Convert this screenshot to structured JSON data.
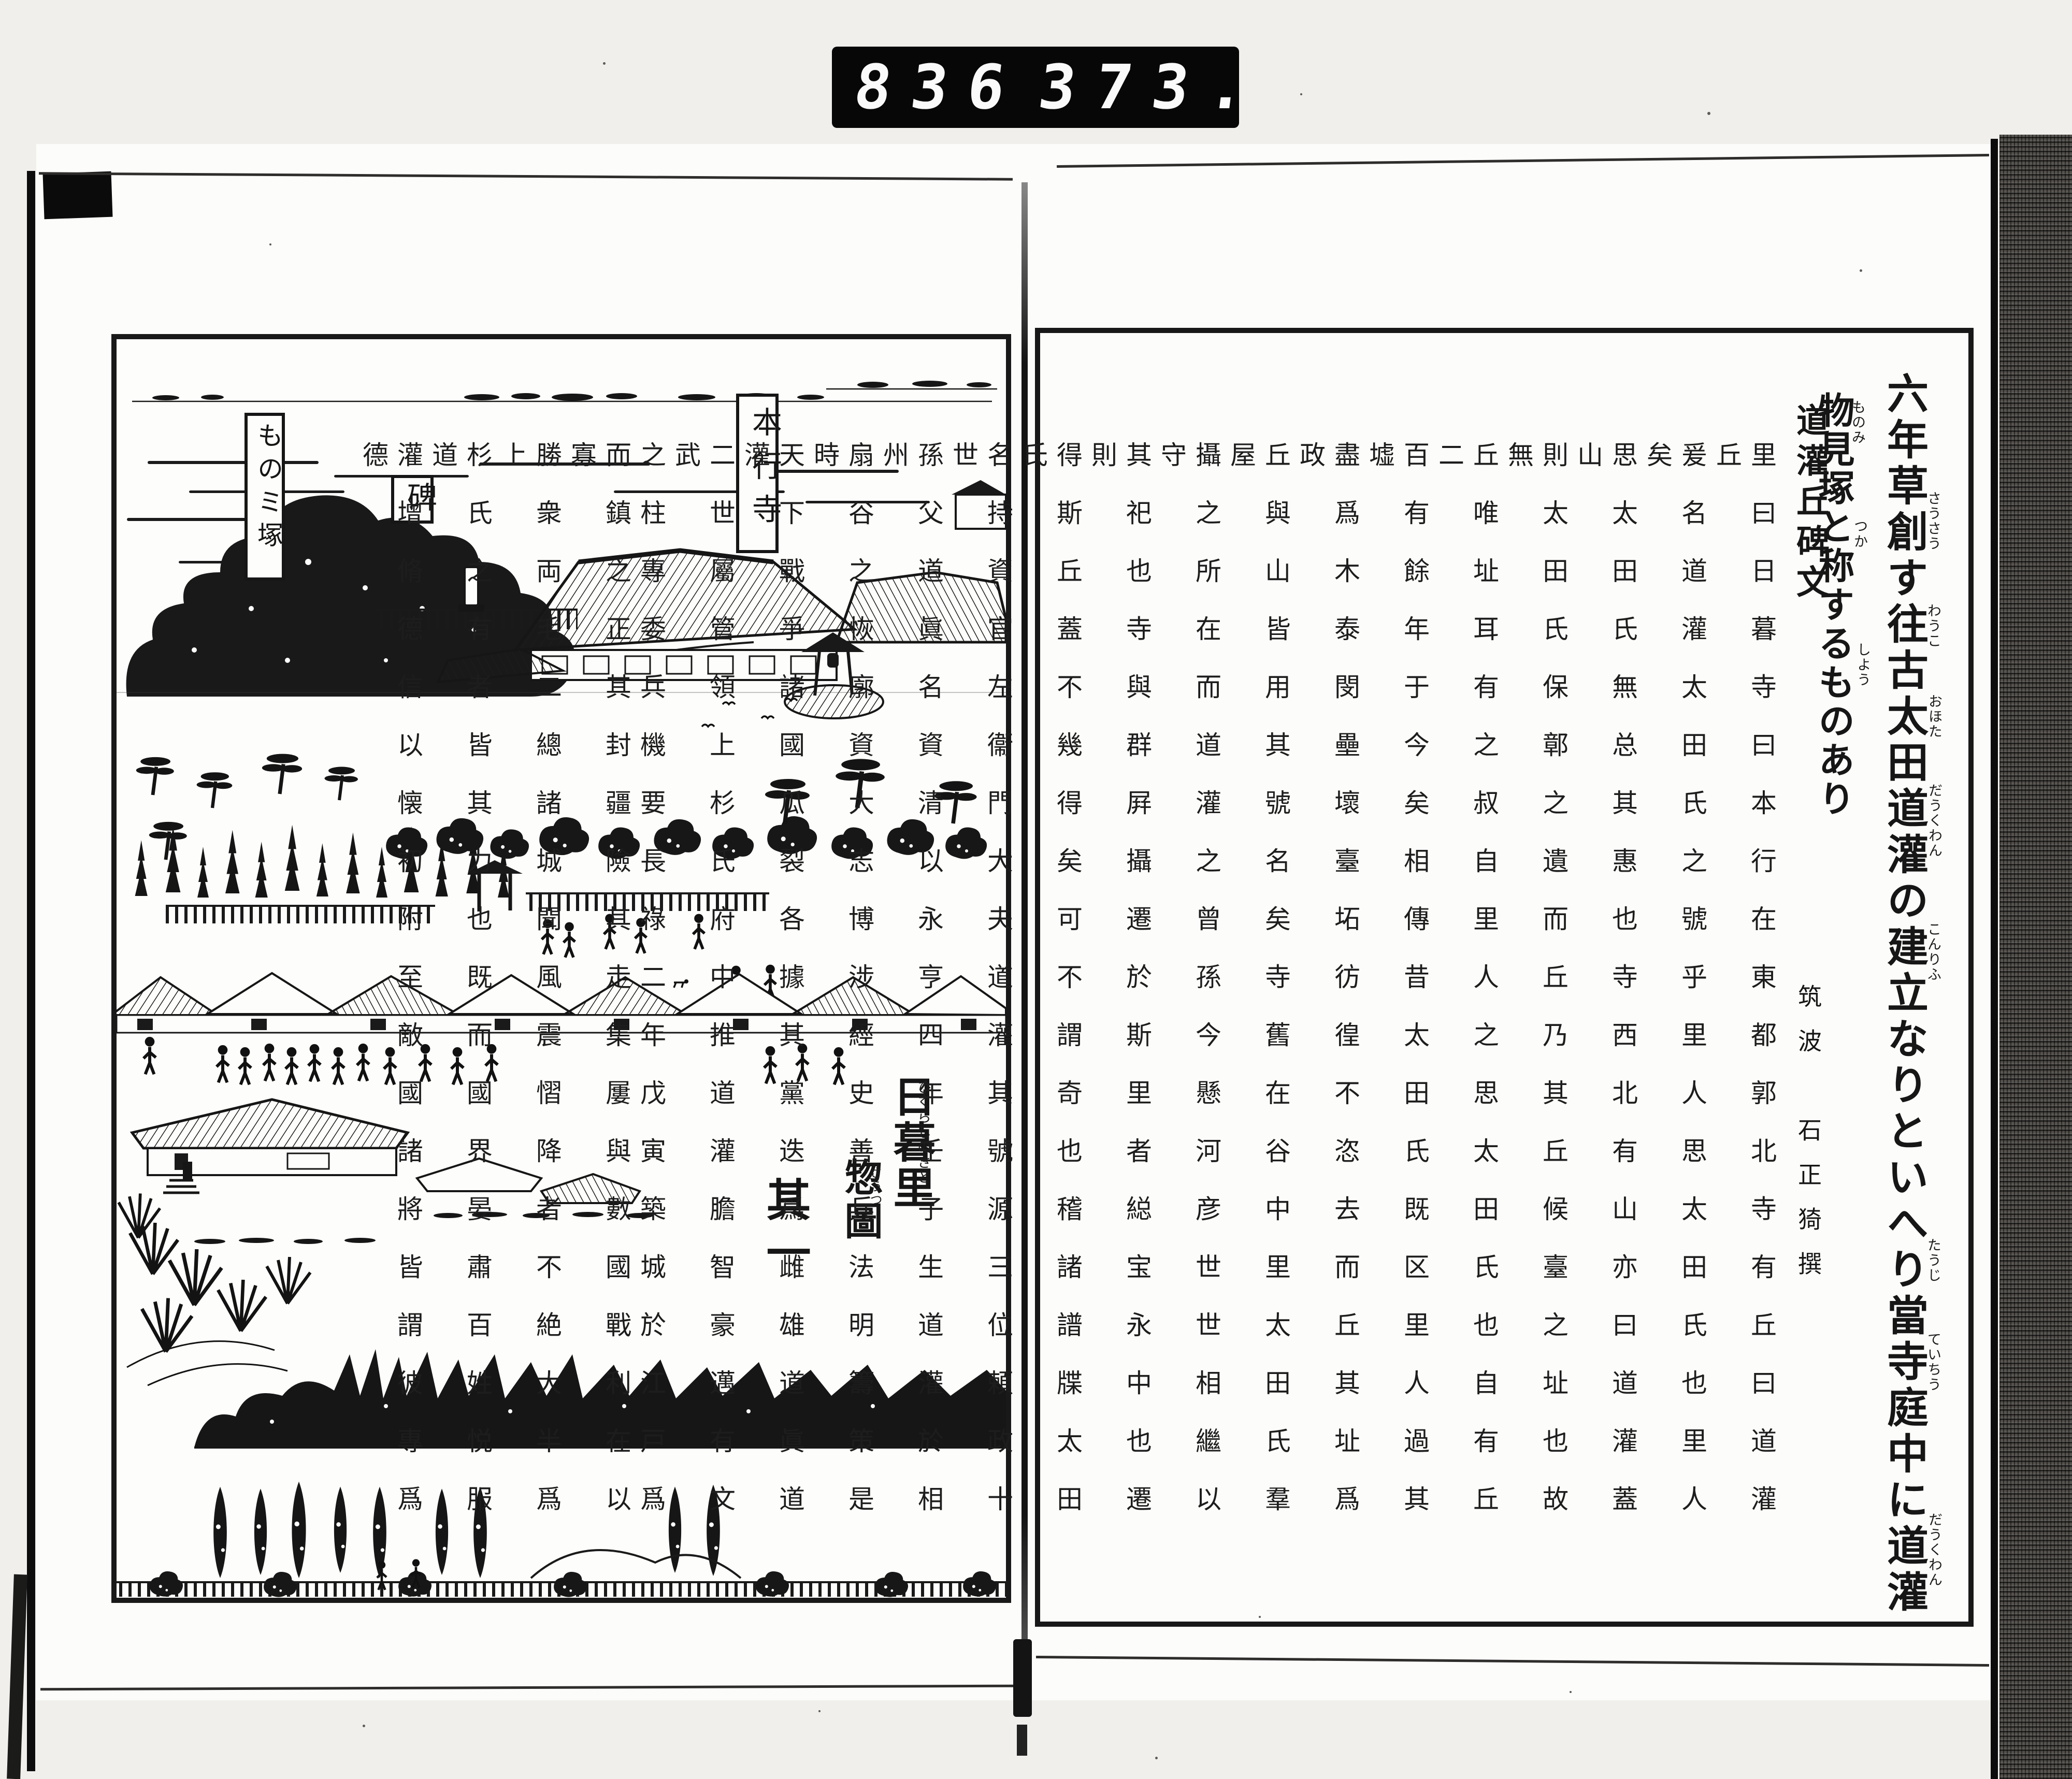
{
  "scan": {
    "frame_counter": {
      "left": "836",
      "right": "373."
    },
    "colors": {
      "ink": "#1a1a1a",
      "paper": "#fcfcfa",
      "background": "#f0efec",
      "counter_bg": "#070707",
      "counter_digit": "#fafafa",
      "film_strip": "#53504c"
    }
  },
  "left_page": {
    "cartouches": [
      {
        "label": "ものミ塚"
      },
      {
        "label": "碑"
      },
      {
        "label": "本行寺"
      }
    ],
    "illustration_title": {
      "main": "日暮里",
      "main_furigana": "ひくらしのさと",
      "sub": "惣圖",
      "sub_furigana": "さうつ",
      "part": "其一"
    }
  },
  "right_page": {
    "headline": {
      "line1": "六年草創す往古太田道灌の建立なりといへり當寺庭中に道灌",
      "line2": "物見塚と称するものあり",
      "furigana": [
        "さうさう",
        "わうこ",
        "おほた",
        "だうくわん",
        "こんりふ",
        "たうじ",
        "ていちう",
        "だうくわん",
        "ものみ",
        "つか",
        "しよう"
      ]
    },
    "inscription": {
      "title": "道灌丘碑文",
      "author": "筑波　石正猗撰",
      "columns": [
        "里曰日暮寺曰本行在東都郭北寺有丘曰道灌丘",
        "爰名道灌太田氏之號乎里人思太田氏也里人矣",
        "思太田氏無总其惠也寺西北有山亦曰道灌蓋山",
        "則太田氏保鄣之遺而丘乃其丘候臺之址也故無",
        "丘唯址耳有之叔自里人之思太田氏也自有丘二",
        "百有餘年于今矣相傳昔太田氏既区里人過其墟",
        "盡爲木泰閔壘壞臺坧彷徨不恣去而丘其址爲政",
        "丘與山皆用其號名矣寺舊在谷中里太田氏羣屋",
        "攝之所在而道灌之曾孫今懸河彦世世相繼以守",
        "其祀也寺與群屛攝遷於斯里者縂宝永中也遷則",
        "得斯丘蓋不幾得矣可不謂奇也稽諸譜牒太田氏",
        "名持資官左衞門大夫道灌其號源三位頼政十世",
        "孫父道眞名資清以永亨四年壬子生道灌於相州",
        "扇谷之恢廓資大志博涉經史善兵法明籌策是時",
        "天下戰爭諸國瓜裂各據其黨迭爲雌雄道眞道灌",
        "二世屬管領上杉氏府中推道灌膽智豪邁有文武",
        "之柱專委兵機要長祿二年戊寅築城於江戸爲",
        "而鎮之正其封疆險其走集屢與數國戰利在以寡",
        "勝衆両毛二總諸城聞風震慴降者不絶大半爲上",
        "杉氏之有者皆其力也既而國界晏肅百姓悦服道",
        "灌增脩德信以懐初附至敵國諸將皆謂彼專爲德"
      ]
    }
  }
}
